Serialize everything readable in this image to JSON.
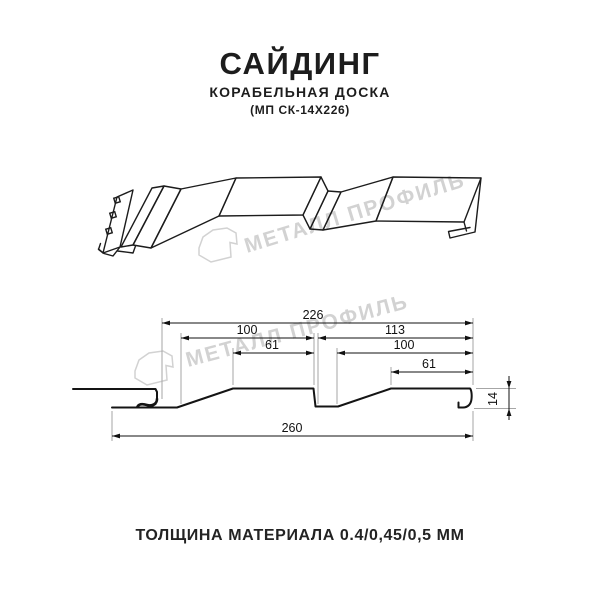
{
  "header": {
    "title": "САЙДИНГ",
    "subtitle": "КОРАБЕЛЬНАЯ ДОСКА",
    "model": "(МП СК-14Х226)"
  },
  "watermark": {
    "brand": "МЕТАЛЛ ПРОФИЛЬ",
    "color": "#d2d2d2"
  },
  "drawing": {
    "type": "siding-profile-technical-drawing",
    "dims": {
      "panel_cover_width": "226",
      "board1_width": "100",
      "board2_width": "113",
      "slope1_width": "61",
      "board2_flat": "100",
      "slope2_width": "61",
      "overall_width": "260",
      "profile_height": "14"
    }
  },
  "footer": {
    "thickness": "ТОЛЩИНА МАТЕРИАЛА 0.4/0,45/0,5 ММ"
  }
}
